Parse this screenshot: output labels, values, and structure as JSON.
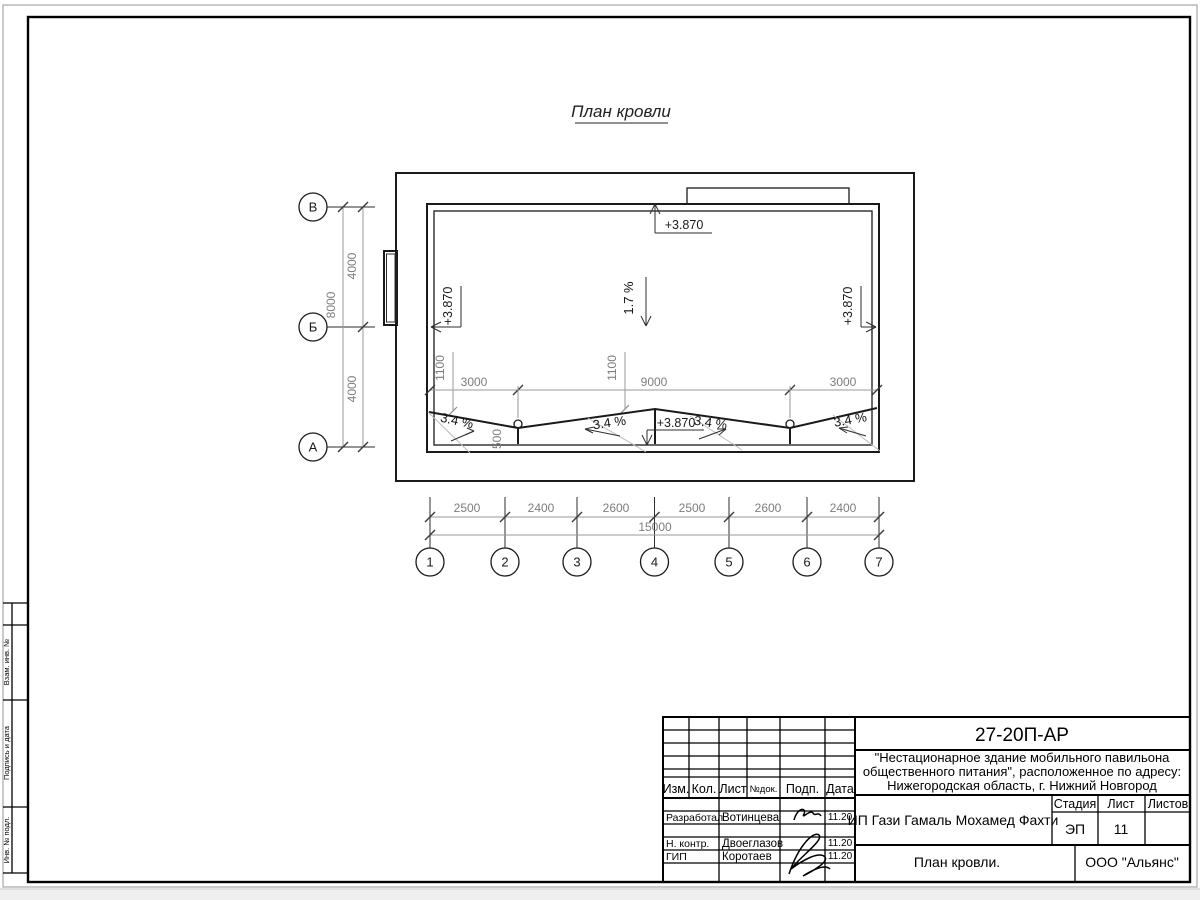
{
  "drawing_title": "План кровли",
  "plan": {
    "elevation_mark": "+3.870",
    "main_slope": "1.7 %",
    "valley_slope": "3.4 %",
    "row_axes": [
      "В",
      "Б",
      "А"
    ],
    "col_axes": [
      "1",
      "2",
      "3",
      "4",
      "5",
      "6",
      "7"
    ],
    "dims": {
      "row_segments": [
        "4000",
        "4000"
      ],
      "row_total": "8000",
      "col_segments": [
        "2500",
        "2400",
        "2600",
        "2500",
        "2600",
        "2400"
      ],
      "col_total": "15000",
      "roof_segments": [
        "3000",
        "9000",
        "3000"
      ],
      "valley_offset": "1100",
      "drain_offset": "500"
    }
  },
  "stamp_side": {
    "labels": [
      "Взам. инв. №",
      "Подпись и дата",
      "Инв. № подл."
    ]
  },
  "titleblock": {
    "doc_number": "27-20П-АР",
    "project_lines": [
      "\"Нестационарное здание мобильного павильона",
      "общественного питания\", расположенное по адресу:",
      "Нижегородская область, г. Нижний Новгород"
    ],
    "client": "ИП Гази Гамаль Мохамед Фахти",
    "sheet_name": "План кровли.",
    "company": "ООО \"Альянс\"",
    "stage_label": "Стадия",
    "sheet_label": "Лист",
    "sheets_label": "Листов",
    "stage_value": "ЭП",
    "sheet_value": "11",
    "header_cols": [
      "Изм.",
      "Кол.",
      "Лист",
      "№док.",
      "Подп.",
      "Дата"
    ],
    "signoff_rows": [
      {
        "role": "Разработал",
        "name": "Вотинцева",
        "date": "11.20"
      },
      {
        "role": "Н. контр.",
        "name": "Двоеглазов",
        "date": "11.20"
      },
      {
        "role": "ГИП",
        "name": "Коротаев",
        "date": "11.20"
      }
    ]
  }
}
